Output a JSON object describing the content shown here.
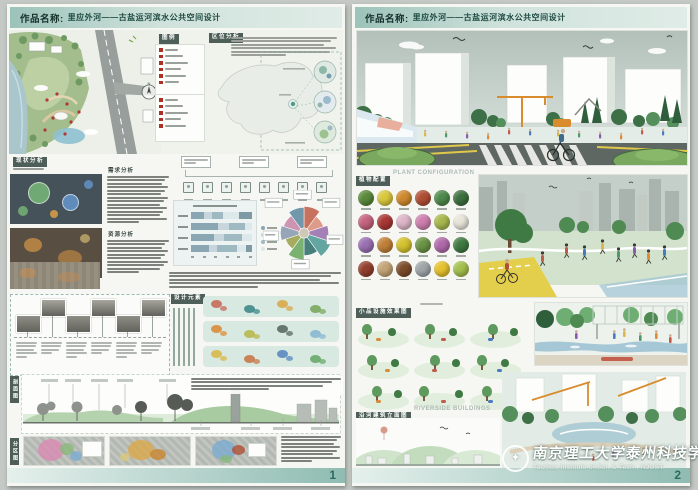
{
  "shared": {
    "header_label": "作品名称:",
    "title": "里应外河——古盐运河滨水公共空间设计"
  },
  "colors": {
    "header_teal": "#9cc3b9",
    "footer_teal": "#8fbcb2",
    "label_dark": "#4e5f5a",
    "page_number": "#2a6b60",
    "legend_marker_red": "#ad2f26"
  },
  "left": {
    "page": "1",
    "labels": {
      "location": "区位分析",
      "legend": "图例",
      "status": "现状分析",
      "demand": "需求分析",
      "resource": "资源分析",
      "elements": "设计元素",
      "section_view": "剖面图",
      "zoning": "分区图"
    },
    "compass_n": "N",
    "legend_groups": [
      6,
      5
    ],
    "analysis_chart": {
      "type": "stacked-bar-horizontal",
      "rows": 4,
      "bars": [
        [
          22,
          12,
          18,
          26,
          22
        ],
        [
          45,
          18,
          25,
          12
        ],
        [
          38,
          16,
          30,
          16
        ],
        [
          30,
          12,
          34,
          14,
          10
        ]
      ],
      "colors": [
        "#8aa6b2",
        "#c6d6dc",
        "#9fb9c2",
        "#dce8ea",
        "#7e98a4"
      ]
    },
    "rose": {
      "colors": [
        "#c0604a",
        "#d98f7a",
        "#9a6fae",
        "#4e9a94",
        "#2e6e6a",
        "#6aa85e",
        "#9aa04a",
        "#8a9ab0",
        "#c888a8",
        "#5e8aa0"
      ],
      "radii": [
        26,
        20,
        24,
        28,
        22,
        26,
        19,
        23,
        21,
        25
      ]
    },
    "timeline_count": 6,
    "element_strips": [
      [
        "#c86a5a",
        "#3f8a8a",
        "#d9a84a",
        "#7aa85e"
      ],
      [
        "#d98c3a",
        "#b8b84e",
        "#5a6a66",
        "#88b8d0"
      ],
      [
        "#d9b84a",
        "#c8784a",
        "#5a8ac0",
        "#6aa86a"
      ]
    ]
  },
  "right": {
    "page": "2",
    "labels": {
      "plants_cn": "植物配置",
      "plants_en": "PLANT CONFIGURATION",
      "vignettes_cn": "小品设施效果图",
      "riverside_cn": "沿河建筑立面图",
      "riverside_en": "RIVERSIDE BUILDINGS"
    },
    "plants": {
      "rows": [
        [
          "#5a8a3c",
          "#d9c83e",
          "#cf8a2e",
          "#b04f35",
          "#4f8a4c",
          "#3e703e"
        ],
        [
          "#c4647e",
          "#a83836",
          "#dcb6c8",
          "#cf7fae",
          "#a8b84e",
          "#e7e5da"
        ],
        [
          "#9a70b2",
          "#c08038",
          "#d4c22e",
          "#6b9446",
          "#b06aaa",
          "#3f7a42"
        ],
        [
          "#93402e",
          "#c4a478",
          "#7c4c2a",
          "#9fa6a8",
          "#e6c22e",
          "#a4c04e"
        ]
      ]
    },
    "vignettes": {
      "rows": 3,
      "cols": 3
    }
  },
  "watermark": {
    "cn": "南京理工大学泰州科技学院",
    "en": "Taizhou Institute of Sci. & Tech., NJUST."
  }
}
